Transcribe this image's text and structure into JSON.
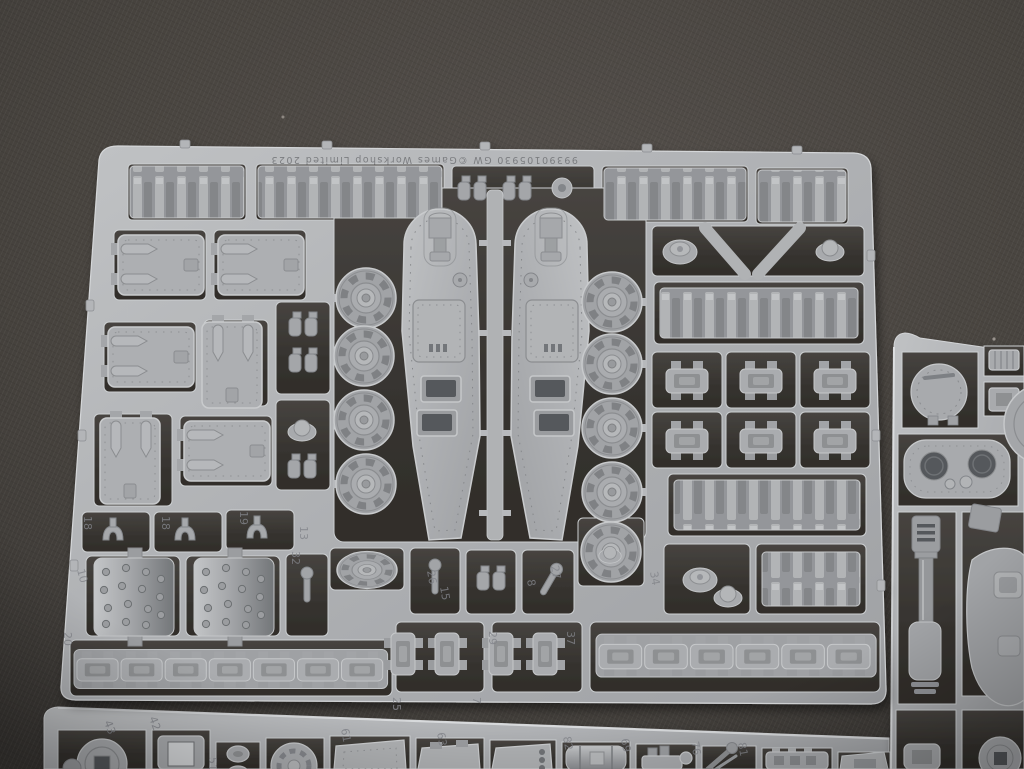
{
  "scene": {
    "subject": "grey plastic model kit sprues on dark textured surface",
    "colors": {
      "background": "#48443f",
      "plastic_light": "#c4c6c8",
      "plastic_base": "#aaacaf",
      "plastic_shadow": "#84868a",
      "cell_opening": "#3a3734"
    }
  },
  "main_sprue": {
    "molded_text": "99390105930   GW   ©Games Workshop Limited 2023",
    "part_numbers": [
      "18",
      "18",
      "19",
      "10",
      "20",
      "13",
      "32",
      "26",
      "15",
      "8",
      "27",
      "34",
      "29",
      "37",
      "25",
      "7"
    ]
  },
  "bottom_sprue": {
    "part_numbers": [
      "43",
      "42",
      "51",
      "61",
      "63",
      "82",
      "69",
      "76",
      "81"
    ]
  }
}
